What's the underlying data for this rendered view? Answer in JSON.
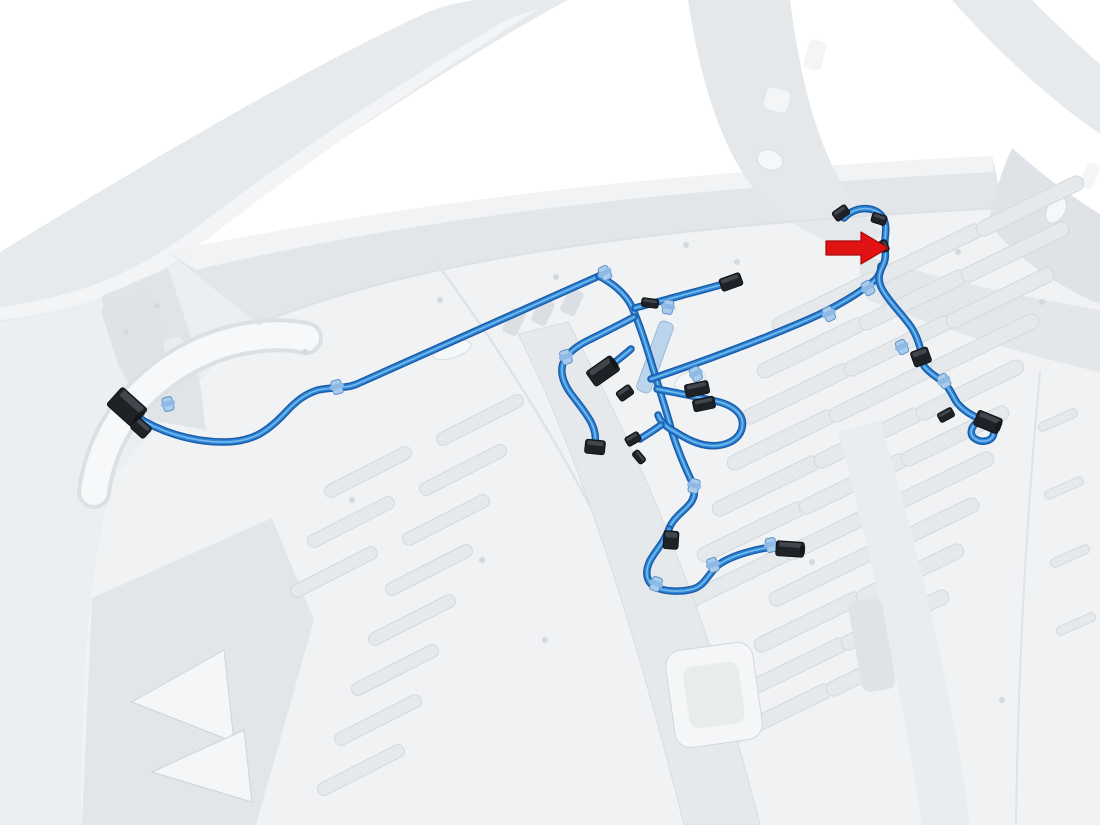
{
  "meta": {
    "kind": "technical-illustration",
    "subject": "vehicle-body-wiring-harness-routing",
    "highlighted_part": "bed-wiring-harness",
    "callout_target": "harness-clip"
  },
  "palette": {
    "background": "#ffffff",
    "body_light": "#f0f2f4",
    "body_mid": "#e6e9ec",
    "body_shade": "#dfe3e7",
    "body_line": "#d6dadd",
    "harness_core": "#2e86d8",
    "harness_edge": "#1a5ca8",
    "harness_highlight": "#7fc1f0",
    "clip_blue": "#a9cbec",
    "clip_blue_edge": "#5d93c8",
    "connector_dark": "#1e2126",
    "connector_edge": "#0c0e10",
    "connector_top": "#454b52",
    "arrow_red": "#e01212",
    "arrow_edge": "#a50b0b"
  },
  "canvas": {
    "width": 1100,
    "height": 825
  },
  "body": {
    "shapes_under": [
      {
        "name": "left-side-panel",
        "d": "M 0,318 C 60,310 118,290 168,252 L 258,322 C 206,378 152,430 114,478 C 92,560 80,660 82,825 L 0,825 Z",
        "fill": "#eceff1"
      },
      {
        "name": "roof-rail",
        "d": "M 0,252 C 148,162 298,72 428,12 C 446,5 460,2 476,0 L 568,0 C 482,46 332,142 182,252 C 126,292 62,314 0,322 Z",
        "fill": "#e7eaed"
      },
      {
        "name": "roof-rail-inner-edge",
        "d": "M 0,307 C 70,298 132,276 190,232 C 300,148 420,70 510,18 L 540,8 C 470,52 340,136 206,240 C 142,288 74,312 0,320 Z",
        "fill": "#f2f4f6"
      },
      {
        "name": "bulkhead-panel",
        "d": "M 168,252 C 430,198 680,172 992,156 L 1004,208 C 712,222 432,252 258,324 Z",
        "fill": "#e2e6e9"
      },
      {
        "name": "bulkhead-top-ledge",
        "d": "M 168,252 C 430,198 680,172 992,156 L 994,172 C 688,188 430,214 196,270 Z",
        "fill": "#f1f3f5"
      },
      {
        "name": "bed-floor",
        "d": "M 258,324 C 432,252 712,222 1004,208 L 1100,272 L 1100,825 L 82,825 C 80,660 92,560 114,478 C 152,430 206,378 258,324 Z",
        "fill": "#f0f2f4"
      },
      {
        "name": "b-pillar",
        "d": "M 688,0 L 790,0 C 798,62 812,132 840,180 C 855,205 868,220 884,232 L 860,254 C 818,240 784,222 758,194 C 722,152 700,80 688,0 Z",
        "fill": "#e5e8eb"
      },
      {
        "name": "right-roof-rail",
        "d": "M 952,0 L 1032,0 C 1062,30 1086,52 1100,64 L 1100,134 C 1048,98 998,52 952,0 Z",
        "fill": "#e7eaed"
      },
      {
        "name": "bed-side-rail",
        "d": "M 860,254 C 950,282 1040,300 1100,310 L 1100,372 C 1028,356 944,330 868,300 C 860,284 858,268 860,254 Z",
        "fill": "#e4e7ea"
      },
      {
        "name": "corner-bracket",
        "d": "M 1012,148 C 1048,180 1080,202 1100,214 L 1100,304 C 1052,284 1012,254 988,222 C 994,196 1002,170 1012,148 Z",
        "fill": "#dfe3e7"
      },
      {
        "name": "left-lower-panel",
        "d": "M 92,598 L 272,518 L 314,620 L 256,825 L 82,825 Z",
        "fill": "#e3e6e9"
      },
      {
        "name": "triangle-cutout-1",
        "d": "M 132,702 L 224,650 L 234,742 Z",
        "fill": "#f4f6f7",
        "stroke": "#cfd4d8"
      },
      {
        "name": "triangle-cutout-2",
        "d": "M 152,772 L 244,730 L 252,802 Z",
        "fill": "#f4f6f7",
        "stroke": "#cfd4d8"
      },
      {
        "name": "cab-corner-bracket",
        "d": "M 102,296 L 168,268 L 196,352 L 206,430 L 150,420 C 122,380 106,338 102,296 Z",
        "fill": "#e0e4e7"
      }
    ],
    "rects_under": [
      {
        "name": "bracket-plate",
        "x": 136,
        "y": 332,
        "w": 54,
        "h": 70,
        "a": -18,
        "rx": 8,
        "fill": "#dfe3e6"
      },
      {
        "name": "bracket-slot",
        "x": 176,
        "y": 352,
        "w": 20,
        "h": 28,
        "a": -18,
        "rx": 4,
        "fill": "#eaedef"
      },
      {
        "name": "pillar-hole-1",
        "x": 815,
        "y": 55,
        "w": 18,
        "h": 30,
        "a": 15,
        "rx": 5,
        "fill": "#f3f5f6"
      },
      {
        "name": "pillar-hole-2",
        "x": 777,
        "y": 100,
        "w": 24,
        "h": 22,
        "a": 15,
        "rx": 6,
        "fill": "#f3f5f6"
      },
      {
        "name": "rail-slot",
        "x": 1090,
        "y": 176,
        "w": 14,
        "h": 26,
        "a": 25,
        "rx": 4,
        "fill": "#f4f6f7"
      },
      {
        "name": "bulkhead-notch-1",
        "x": 514,
        "y": 322,
        "w": 16,
        "h": 26,
        "a": 25,
        "rx": 3,
        "fill": "#dbdfe3"
      },
      {
        "name": "bulkhead-notch-2",
        "x": 543,
        "y": 312,
        "w": 16,
        "h": 26,
        "a": 25,
        "rx": 3,
        "fill": "#dbdfe3"
      },
      {
        "name": "bulkhead-notch-3",
        "x": 572,
        "y": 302,
        "w": 16,
        "h": 26,
        "a": 25,
        "rx": 3,
        "fill": "#dbdfe3"
      }
    ],
    "strokes": [
      {
        "name": "wheel-arch-shadow",
        "d": "M 94,492 C 102,430 142,378 206,350 C 240,336 276,332 306,338",
        "w": 34,
        "color": "#dce0e3"
      },
      {
        "name": "wheel-arch",
        "d": "M 94,492 C 102,430 142,378 206,350 C 240,336 276,332 306,338",
        "w": 26,
        "color": "#f6f8f9"
      },
      {
        "name": "bulkhead-seam",
        "d": "M 258,324 C 432,252 712,222 1004,208",
        "w": 2,
        "color": "#dde1e5"
      },
      {
        "name": "floor-seam-left",
        "d": "M 436,262 C 560,430 660,620 724,825",
        "w": 2.5,
        "color": "#dfe3e7"
      },
      {
        "name": "floor-seam-right",
        "d": "M 1040,372 C 1026,520 1018,670 1016,825",
        "w": 2,
        "color": "#dfe3e7"
      }
    ],
    "ovals": [
      {
        "name": "floor-oval-hole",
        "x": 690,
        "y": 381,
        "rx": 16,
        "ry": 9,
        "a": -20
      },
      {
        "name": "ledge-oval-hole",
        "x": 452,
        "y": 350,
        "rx": 20,
        "ry": 8,
        "a": -18
      },
      {
        "name": "pillar-oval-hole",
        "x": 770,
        "y": 160,
        "rx": 13,
        "ry": 10,
        "a": 20
      },
      {
        "name": "bracket-oval-hole",
        "x": 1056,
        "y": 210,
        "rx": 9,
        "ry": 14,
        "a": 30
      }
    ],
    "dots": [
      [
        737,
        262
      ],
      [
        686,
        245
      ],
      [
        556,
        277
      ],
      [
        440,
        300
      ],
      [
        305,
        352
      ],
      [
        958,
        252
      ],
      [
        1042,
        302
      ],
      [
        872,
        470
      ],
      [
        812,
        562
      ],
      [
        545,
        640
      ],
      [
        482,
        560
      ],
      [
        352,
        500
      ],
      [
        902,
        640
      ],
      [
        1002,
        700
      ],
      [
        126,
        332
      ],
      [
        157,
        306
      ]
    ],
    "rib_fields": [
      {
        "name": "bed-floor-ribs",
        "start": [
          826,
          302
        ],
        "col": [
          102,
          -48
        ],
        "row": [
          -15,
          46
        ],
        "cols": 3,
        "rows": 11,
        "len": 118,
        "thick": 15,
        "angle": -26,
        "side": "right"
      },
      {
        "name": "cab-floor-ribs",
        "start": [
          368,
          472
        ],
        "col": [
          112,
          -52
        ],
        "row": [
          -17,
          50
        ],
        "cols": 2,
        "rows": 8,
        "len": 96,
        "thick": 13,
        "angle": -27,
        "side": "left"
      },
      {
        "name": "edge-strip-ribs",
        "start": [
          1058,
          420
        ],
        "col": [
          0,
          0
        ],
        "row": [
          6,
          68
        ],
        "cols": 1,
        "rows": 6,
        "len": 42,
        "thick": 9,
        "angle": -24,
        "side": "none"
      }
    ],
    "shapes_over": [
      {
        "name": "center-sill",
        "d": "M 518,334 L 568,322 C 632,440 690,572 728,706 C 740,752 752,792 760,825 L 684,825 C 650,688 592,480 518,334 Z",
        "fill": "#e6e9ec",
        "stroke": "#d9dde1"
      },
      {
        "name": "right-channel",
        "d": "M 838,432 L 880,420 C 920,556 952,690 970,825 L 922,825 C 902,690 872,560 838,432 Z",
        "fill": "#eaedef"
      }
    ],
    "rects_over": [
      {
        "name": "sill-access-hole",
        "x": 714,
        "y": 695,
        "w": 88,
        "h": 98,
        "a": -8,
        "rx": 16,
        "fill": "#f4f6f7",
        "stroke": "#d3d7db"
      },
      {
        "name": "sill-access-hole-inner",
        "x": 714,
        "y": 695,
        "w": 56,
        "h": 62,
        "a": -8,
        "rx": 10,
        "fill": "#e9eced"
      },
      {
        "name": "channel-bracket",
        "x": 872,
        "y": 645,
        "w": 34,
        "h": 92,
        "a": -10,
        "rx": 8,
        "fill": "#dfe3e7"
      }
    ]
  },
  "harness": {
    "channel": {
      "name": "harness-conduit-channel",
      "x": 655,
      "y": 357,
      "w": 15,
      "h": 74,
      "a": 20
    },
    "paths": [
      {
        "name": "main-run",
        "d": "M 136,416 C 158,431 190,442 224,442 C 252,442 267,432 285,413 C 296,401 305,394 318,390 C 331,387 345,389 357,384 L 599,276"
      },
      {
        "name": "center-trunk",
        "d": "M 599,276 C 612,283 624,292 631,305 C 641,327 648,352 656,378 C 661,395 665,407 669,421 C 674,441 683,463 692,482 C 696,491 695,499 688,506 C 680,514 672,520 669,529"
      },
      {
        "name": "bottom-loop",
        "d": "M 669,529 C 663,545 653,553 649,563 C 644,575 648,584 657,588 C 668,592 682,592 693,589 C 704,586 708,575 717,566 C 729,556 753,550 771,547 L 787,549"
      },
      {
        "name": "right-cross-branch",
        "d": "M 651,379 C 701,362 761,340 807,320 C 837,307 861,292 875,280 C 879,276 881,271 881,266"
      },
      {
        "name": "right-vertical-run",
        "d": "M 844,218 C 855,206 873,206 881,215 C 887,222 886,231 885,239 C 884,249 887,255 884,263 C 880,271 877,277 881,287 C 887,299 899,311 909,324 C 916,333 919,343 921,351"
      },
      {
        "name": "right-lower-run",
        "d": "M 924,366 C 929,373 937,377 943,382 C 951,389 953,398 958,404 C 964,411 973,416 980,419"
      },
      {
        "name": "top-branch",
        "d": "M 635,308 C 653,303 669,299 683,295 C 699,291 713,287 724,284"
      },
      {
        "name": "left-cluster-branch",
        "d": "M 634,317 C 619,325 603,333 591,339 C 578,345 570,351 565,359 C 559,369 562,380 569,391 C 576,401 585,411 591,422 C 595,430 596,437 595,443"
      },
      {
        "name": "cluster-slack-loop",
        "d": "M 657,389 C 677,393 699,397 715,401 C 734,405 745,415 742,428 C 739,441 723,448 705,445 C 690,442 681,435 672,430 C 665,426 660,421 658,415"
      },
      {
        "name": "stub-to-large-connector",
        "d": "M 631,349 C 623,356 615,362 608,368"
      },
      {
        "name": "stub-to-small-connectors",
        "d": "M 661,425 C 653,431 646,435 640,439"
      },
      {
        "name": "end-wire-loop",
        "d": "M 980,419 C 990,423 996,430 993,436 C 990,442 980,443 974,438 C 969,434 971,426 978,422"
      }
    ],
    "clips": [
      {
        "x": 168,
        "y": 404,
        "a": -15
      },
      {
        "x": 337,
        "y": 387,
        "a": -15
      },
      {
        "x": 605,
        "y": 273,
        "a": -28
      },
      {
        "x": 566,
        "y": 357,
        "a": -20
      },
      {
        "x": 668,
        "y": 307,
        "a": 10
      },
      {
        "x": 696,
        "y": 374,
        "a": -25
      },
      {
        "x": 829,
        "y": 314,
        "a": -25
      },
      {
        "x": 868,
        "y": 288,
        "a": -30
      },
      {
        "x": 902,
        "y": 347,
        "a": -25
      },
      {
        "x": 944,
        "y": 381,
        "a": -30
      },
      {
        "x": 694,
        "y": 486,
        "a": 15
      },
      {
        "x": 656,
        "y": 584,
        "a": 20
      },
      {
        "x": 713,
        "y": 565,
        "a": -20
      },
      {
        "x": 771,
        "y": 545,
        "a": -10
      }
    ],
    "connectors": [
      {
        "x": 127,
        "y": 407,
        "w": 34,
        "h": 24,
        "a": 42,
        "s": "L"
      },
      {
        "x": 141,
        "y": 428,
        "w": 18,
        "h": 14,
        "a": 42,
        "s": "S"
      },
      {
        "x": 650,
        "y": 303,
        "w": 17,
        "h": 9,
        "a": 8,
        "s": "S"
      },
      {
        "x": 731,
        "y": 282,
        "w": 22,
        "h": 13,
        "a": -20,
        "s": "M"
      },
      {
        "x": 603,
        "y": 371,
        "w": 30,
        "h": 18,
        "a": -35,
        "s": "L"
      },
      {
        "x": 625,
        "y": 393,
        "w": 16,
        "h": 11,
        "a": -35,
        "s": "S"
      },
      {
        "x": 697,
        "y": 389,
        "w": 24,
        "h": 13,
        "a": -12,
        "s": "M"
      },
      {
        "x": 704,
        "y": 404,
        "w": 22,
        "h": 12,
        "a": -12,
        "s": "M"
      },
      {
        "x": 595,
        "y": 447,
        "w": 20,
        "h": 14,
        "a": 6,
        "s": "M"
      },
      {
        "x": 633,
        "y": 439,
        "w": 15,
        "h": 10,
        "a": -30,
        "s": "S"
      },
      {
        "x": 639,
        "y": 457,
        "w": 14,
        "h": 8,
        "a": 50,
        "s": "S"
      },
      {
        "x": 671,
        "y": 540,
        "w": 15,
        "h": 18,
        "a": 4,
        "s": "M"
      },
      {
        "x": 790,
        "y": 549,
        "w": 28,
        "h": 15,
        "a": 4,
        "s": "L"
      },
      {
        "x": 841,
        "y": 213,
        "w": 16,
        "h": 11,
        "a": -35,
        "s": "S"
      },
      {
        "x": 879,
        "y": 219,
        "w": 15,
        "h": 10,
        "a": 18,
        "s": "S"
      },
      {
        "x": 884,
        "y": 246,
        "w": 12,
        "h": 8,
        "a": 68,
        "s": "S"
      },
      {
        "x": 921,
        "y": 357,
        "w": 18,
        "h": 16,
        "a": -20,
        "s": "M"
      },
      {
        "x": 946,
        "y": 415,
        "w": 16,
        "h": 10,
        "a": -28,
        "s": "S"
      },
      {
        "x": 988,
        "y": 422,
        "w": 26,
        "h": 16,
        "a": 22,
        "s": "L"
      }
    ]
  },
  "arrow": {
    "name": "callout-arrow",
    "points": "826,241 861,241 861,232 888,248 861,264 861,255 826,255",
    "fill": "#e01212",
    "stroke": "#a50b0b",
    "tip": [
      888,
      248
    ]
  }
}
